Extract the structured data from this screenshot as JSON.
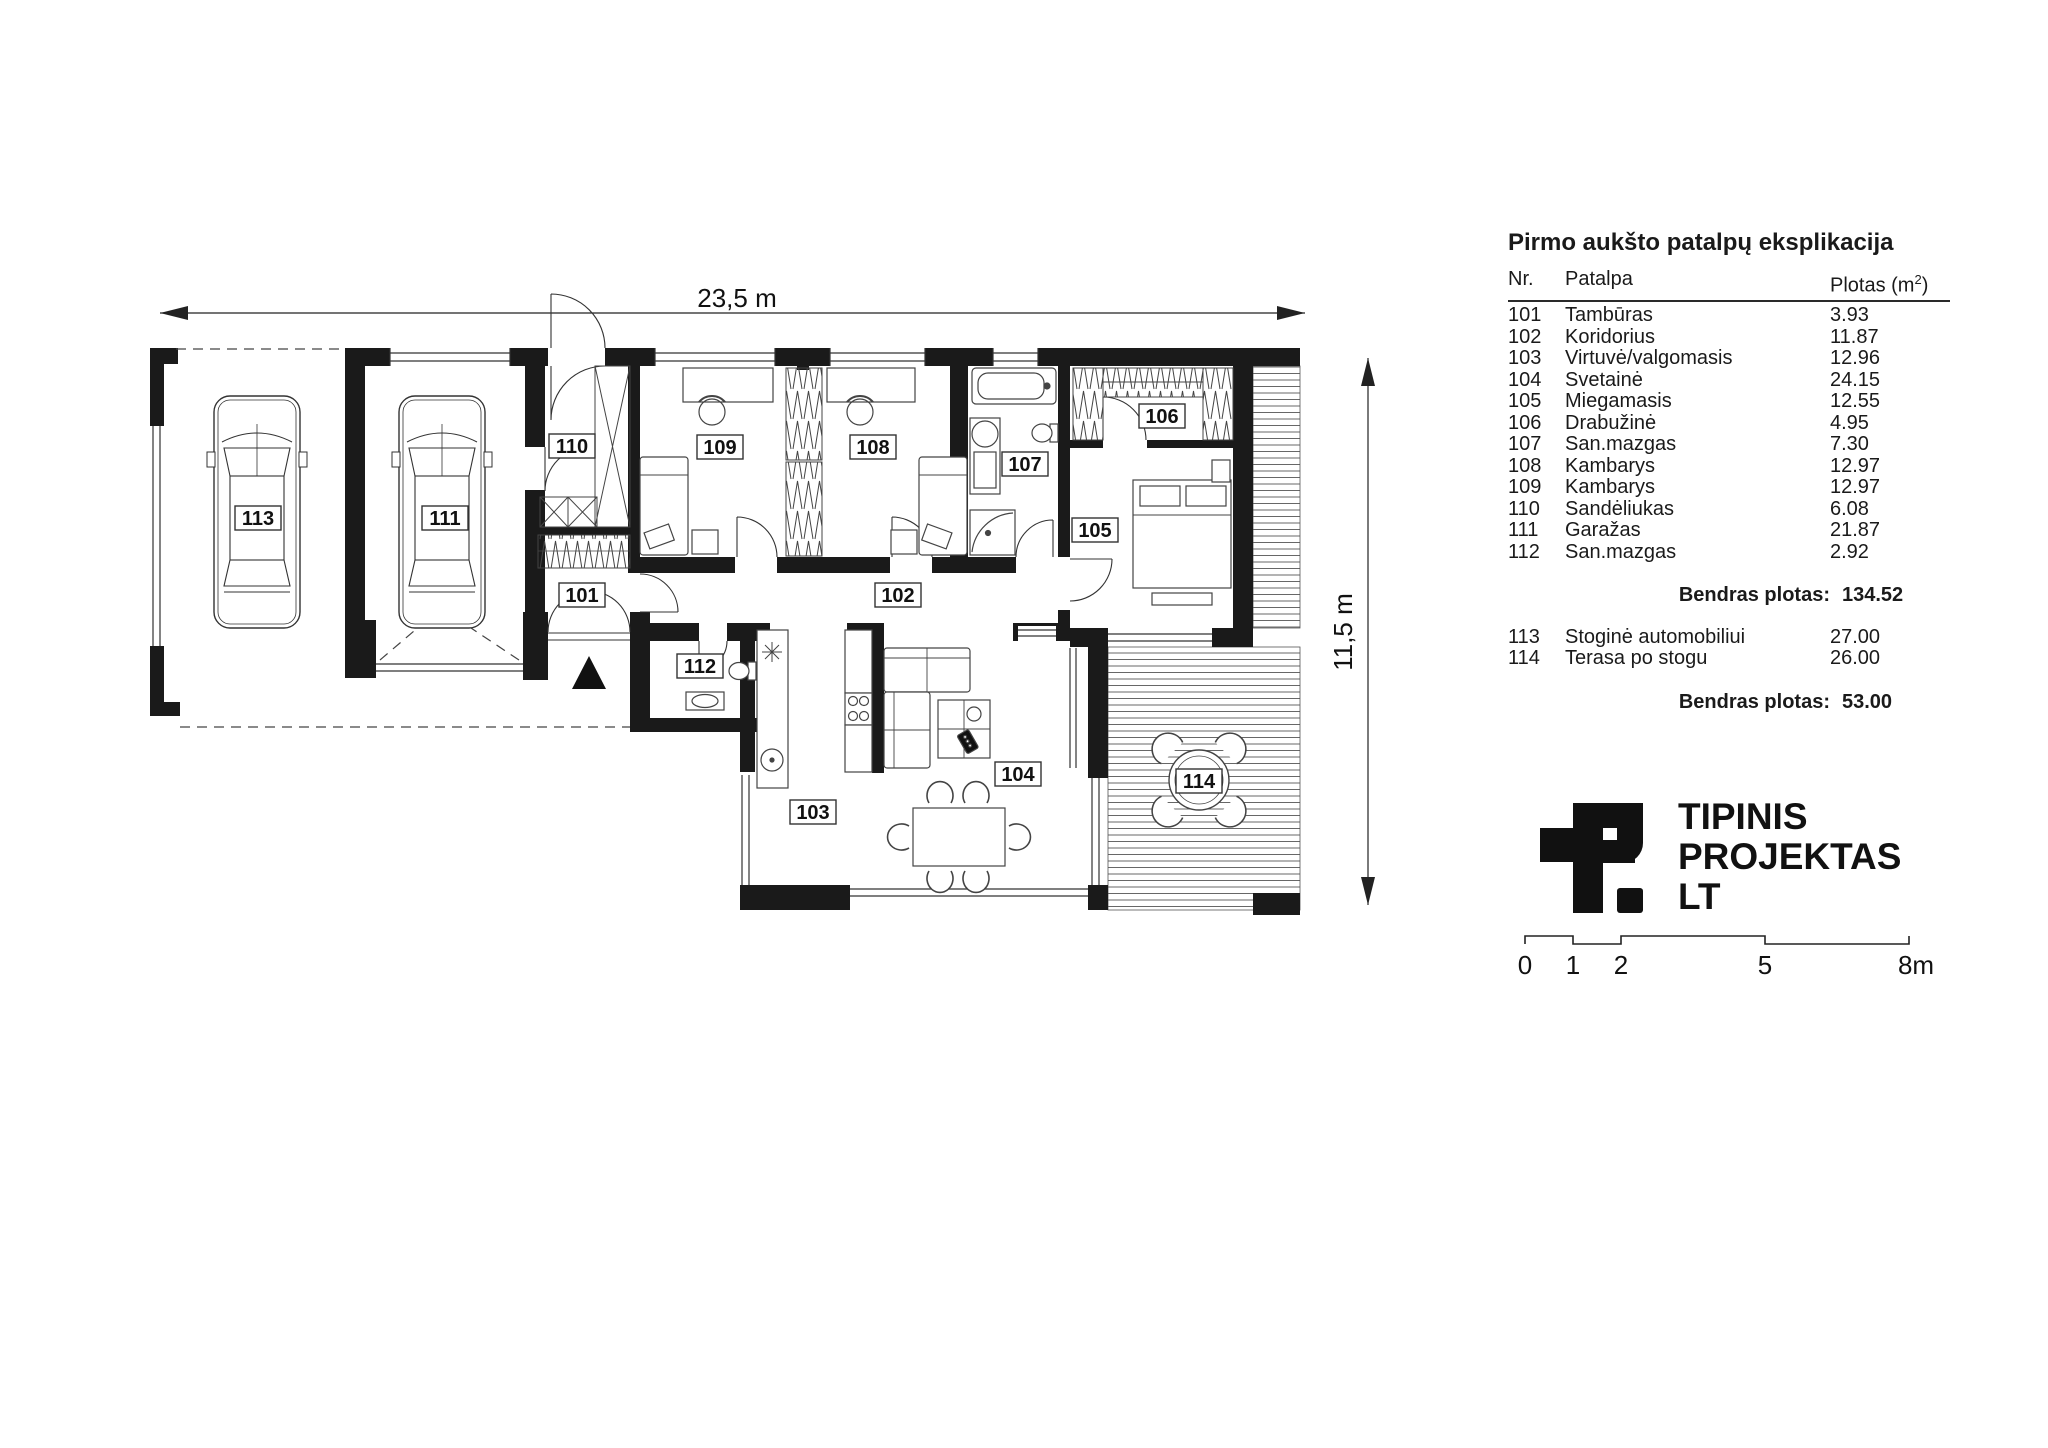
{
  "page": {
    "background": "#ffffff",
    "ink": "#1a1a1a"
  },
  "plan": {
    "width_label": "23,5 m",
    "height_label": "11,5 m"
  },
  "legend": {
    "title": "Pirmo aukšto patalpų eksplikacija",
    "columns": {
      "nr": "Nr.",
      "name": "Patalpa",
      "area_prefix": "Plotas (m",
      "area_sup": "2",
      "area_suffix": ")"
    },
    "rows": [
      {
        "nr": "101",
        "name": "Tambūras",
        "area": "3.93"
      },
      {
        "nr": "102",
        "name": "Koridorius",
        "area": "11.87"
      },
      {
        "nr": "103",
        "name": "Virtuvė/valgomasis",
        "area": "12.96"
      },
      {
        "nr": "104",
        "name": "Svetainė",
        "area": "24.15"
      },
      {
        "nr": "105",
        "name": "Miegamasis",
        "area": "12.55"
      },
      {
        "nr": "106",
        "name": "Drabužinė",
        "area": "4.95"
      },
      {
        "nr": "107",
        "name": "San.mazgas",
        "area": "7.30"
      },
      {
        "nr": "108",
        "name": "Kambarys",
        "area": "12.97"
      },
      {
        "nr": "109",
        "name": "Kambarys",
        "area": "12.97"
      },
      {
        "nr": "110",
        "name": "Sandėliukas",
        "area": "6.08"
      },
      {
        "nr": "111",
        "name": "Garažas",
        "area": "21.87"
      },
      {
        "nr": "112",
        "name": "San.mazgas",
        "area": "2.92"
      }
    ],
    "total1": {
      "label": "Bendras plotas:",
      "value": "134.52"
    },
    "extra_rows": [
      {
        "nr": "113",
        "name": "Stoginė automobiliui",
        "area": "27.00"
      },
      {
        "nr": "114",
        "name": "Terasa po stogu",
        "area": "26.00"
      }
    ],
    "total2": {
      "label": "Bendras plotas:",
      "value": "53.00"
    }
  },
  "logo": {
    "lines": [
      "TIPINIS",
      "PROJEKTAS",
      "LT"
    ]
  },
  "scalebar": {
    "labels": [
      "0",
      "1",
      "2",
      "5",
      "8m"
    ]
  }
}
